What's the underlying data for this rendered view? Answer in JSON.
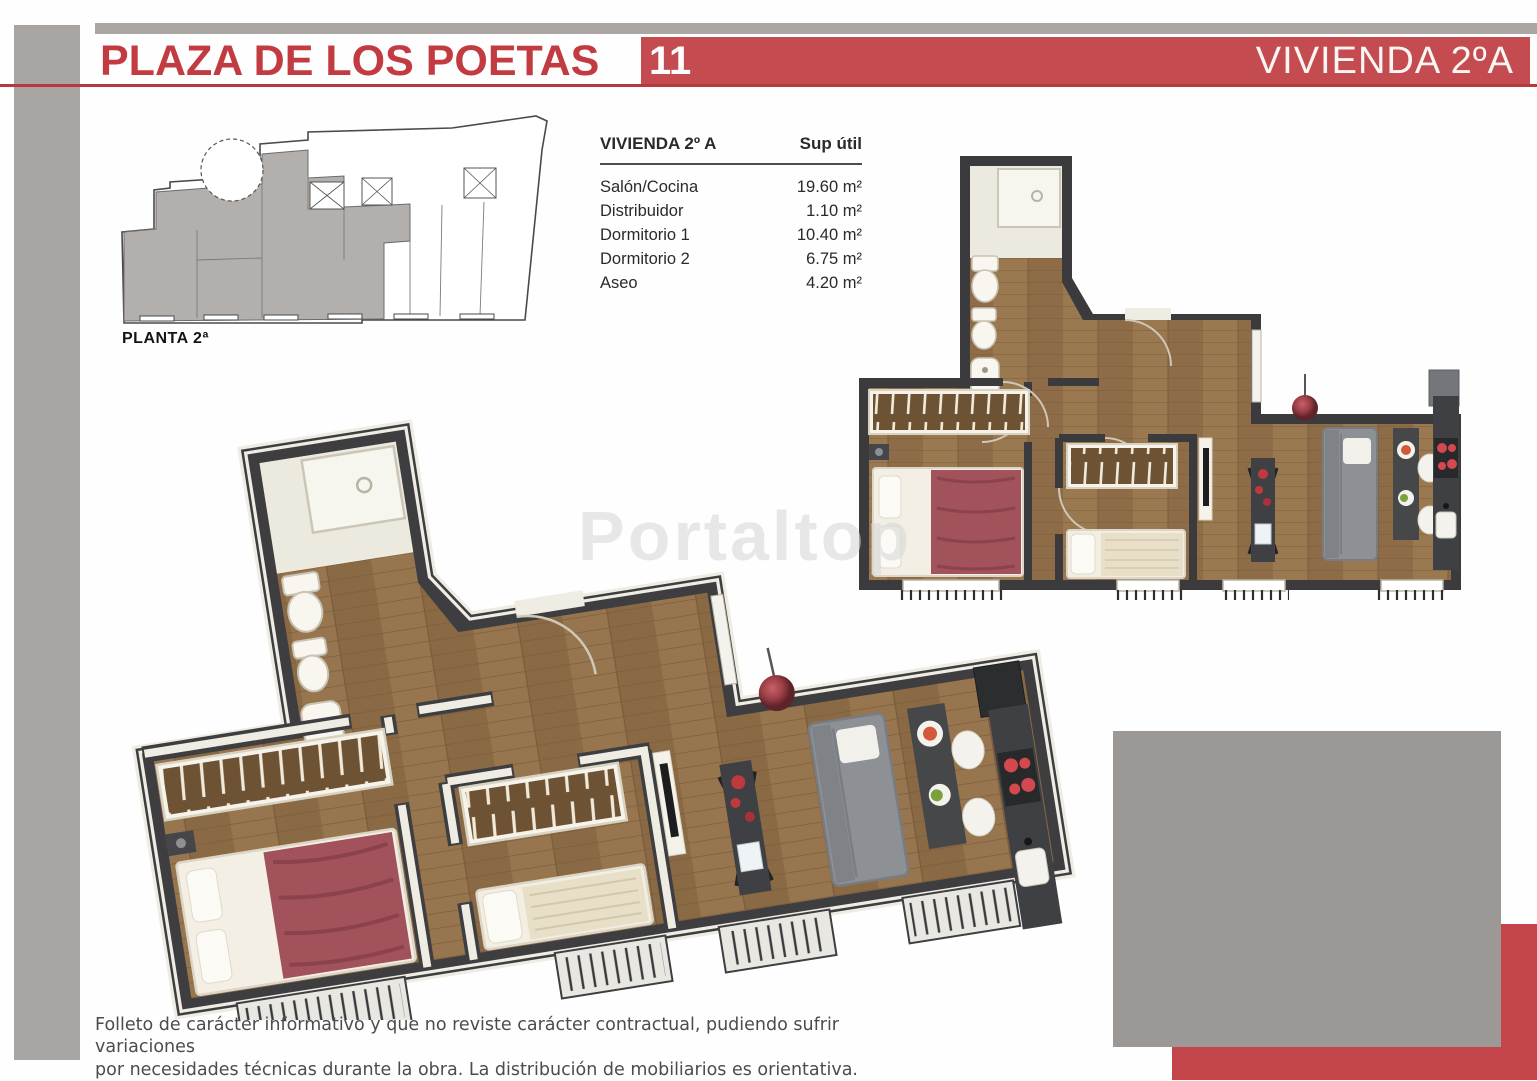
{
  "header": {
    "title": "PLAZA DE LOS POETAS",
    "number": "11",
    "unit_label": "VIVIENDA 2ºA",
    "title_red": "#c23b41",
    "box_red": "#c44b50",
    "bar_gray": "#a9a6a3",
    "rule_red": "#b53a40"
  },
  "key_plan": {
    "label": "PLANTA 2ª",
    "highlight_gray": "#b2afad"
  },
  "surface_table": {
    "title": "VIVIENDA  2º A",
    "column": "Sup útil",
    "rows": [
      {
        "label": "Salón/Cocina",
        "value": "19.60 m²"
      },
      {
        "label": "Distribuidor",
        "value": "1.10 m²"
      },
      {
        "label": "Dormitorio 1",
        "value": "10.40 m²"
      },
      {
        "label": "Dormitorio 2",
        "value": "6.75 m²"
      },
      {
        "label": "Aseo",
        "value": "4.20 m²"
      }
    ]
  },
  "renders": {
    "wall_color": "#3b3b3e",
    "floor_wood": "#9a7850",
    "bath_floor": "#eceade",
    "blanket_maroon": "#a2525a",
    "sofa_gray": "#8d9094",
    "hob_red": "#d4494f",
    "kitchen_dark": "#3e4043"
  },
  "watermark": {
    "text": "Portaltop"
  },
  "decor": {
    "gray_block": "#9c9895",
    "red_block": "#c4464b"
  },
  "footer": {
    "line1": "Folleto de carácter informativo y que no reviste carácter contractual, pudiendo sufrir variaciones",
    "line2": "por necesidades técnicas durante la obra. La distribución de mobiliarios es orientativa."
  }
}
